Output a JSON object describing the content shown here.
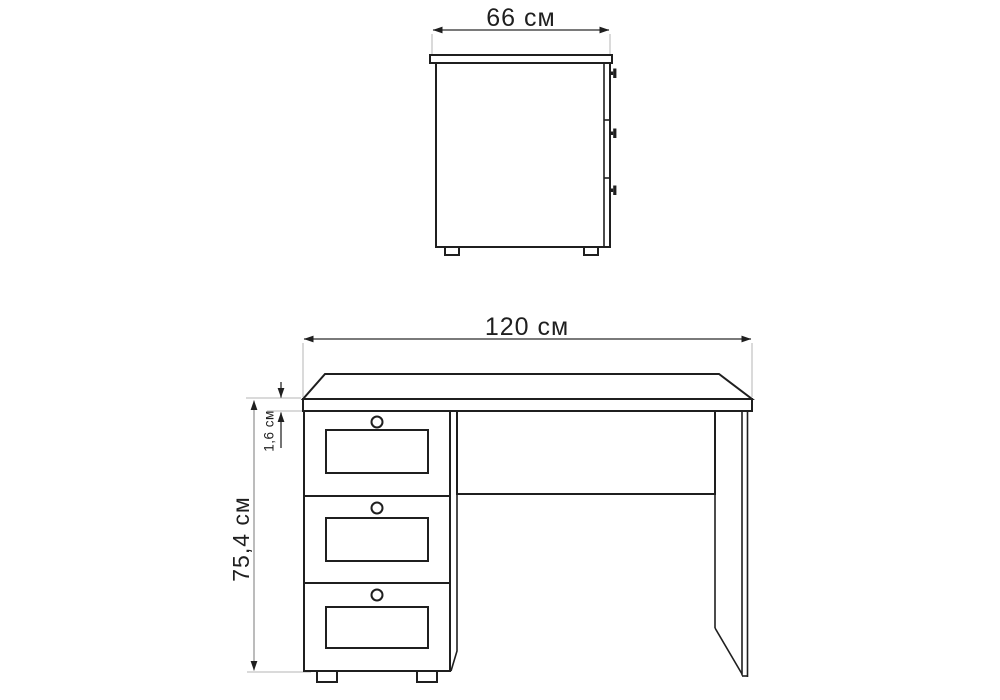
{
  "drawing": {
    "subject": "desk technical drawing with dimensions",
    "style": {
      "background": "#ffffff",
      "outline_color": "#1f1f1f",
      "dimension_color": "#2a2a2a",
      "secondary_dimension_color": "#8f8f8f",
      "extension_line_color": "#b5b5b5",
      "text_color": "#1f1f1f"
    },
    "views": {
      "side": {
        "width_label": "66 см",
        "drawers_visible": 3,
        "knobs_visible": 3,
        "feet_visible": 2
      },
      "front": {
        "width_label": "120 см",
        "height_label": "75,4 см",
        "top_thickness_label": "1,6 см",
        "drawers_visible": 3,
        "knobs_visible": 3,
        "feet_visible": 2
      }
    }
  }
}
